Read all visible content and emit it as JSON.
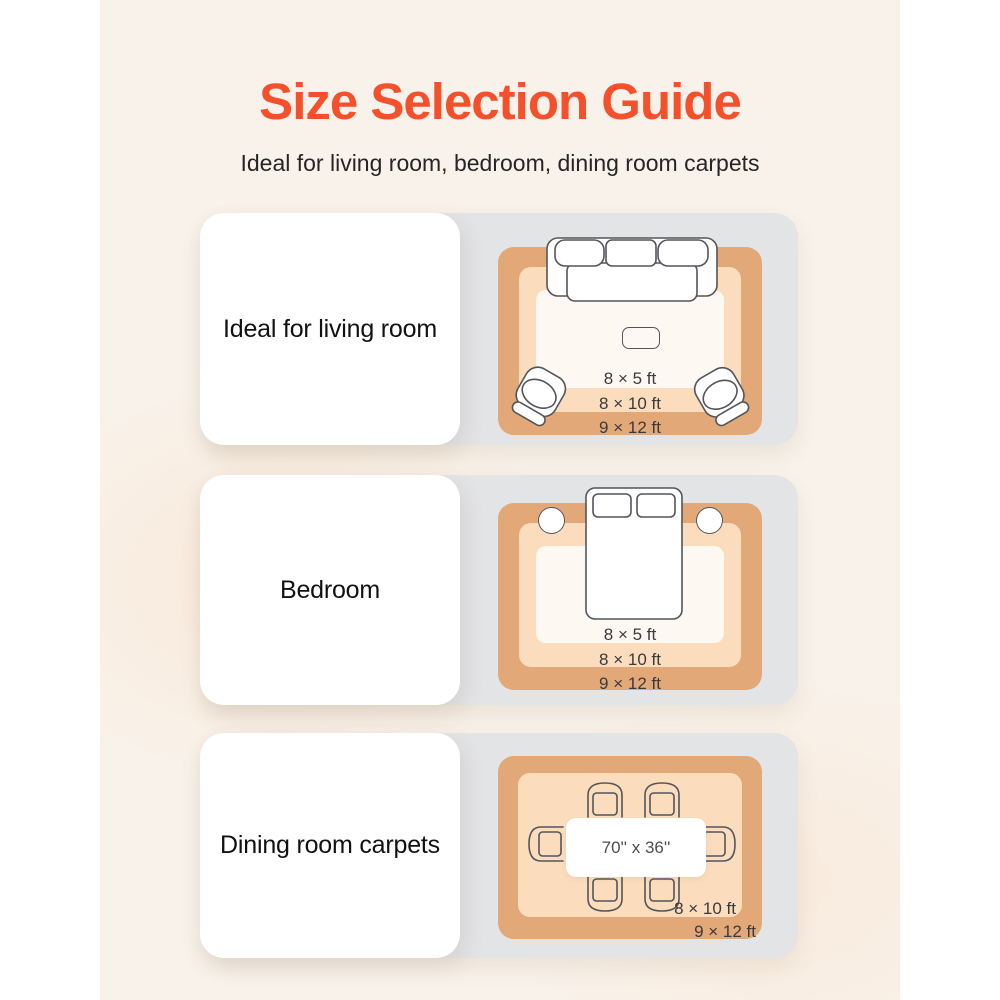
{
  "page": {
    "title": "Size Selection Guide",
    "subtitle": "Ideal for living room, bedroom, dining room carpets"
  },
  "rows": [
    {
      "label": "Ideal for living room",
      "scene": "living-room",
      "sizes": [
        "8 × 5 ft",
        "8 × 10 ft",
        "9 × 12 ft"
      ],
      "furniture": [
        "sofa-icon",
        "coffee-table-icon",
        "armchair-icon",
        "armchair-icon"
      ]
    },
    {
      "label": "Bedroom",
      "scene": "bedroom",
      "sizes": [
        "8 × 5 ft",
        "8 × 10 ft",
        "9 × 12 ft"
      ],
      "furniture": [
        "bed-icon",
        "pillow-icon",
        "pillow-icon",
        "nightstand-icon",
        "nightstand-icon"
      ]
    },
    {
      "label": "Dining room carpets",
      "scene": "dining-room",
      "sizes": [
        "8 × 10 ft",
        "9 × 12 ft"
      ],
      "table_size": "70'' x 36''",
      "furniture": [
        "dining-table-icon",
        "dining-chair-icon",
        "dining-chair-icon",
        "dining-chair-icon",
        "dining-chair-icon",
        "dining-chair-icon",
        "dining-chair-icon"
      ]
    }
  ],
  "colors": {
    "accent": "#F4502B",
    "cream": "#F9F2EA",
    "panel_gray": "#E3E4E6",
    "card_white": "#FFFFFF",
    "rug_outer": "#E2A877",
    "rug_middle": "#FBDDBE",
    "rug_inner": "#FDF8F1",
    "outline": "#53555B",
    "text_dark": "#252528"
  }
}
